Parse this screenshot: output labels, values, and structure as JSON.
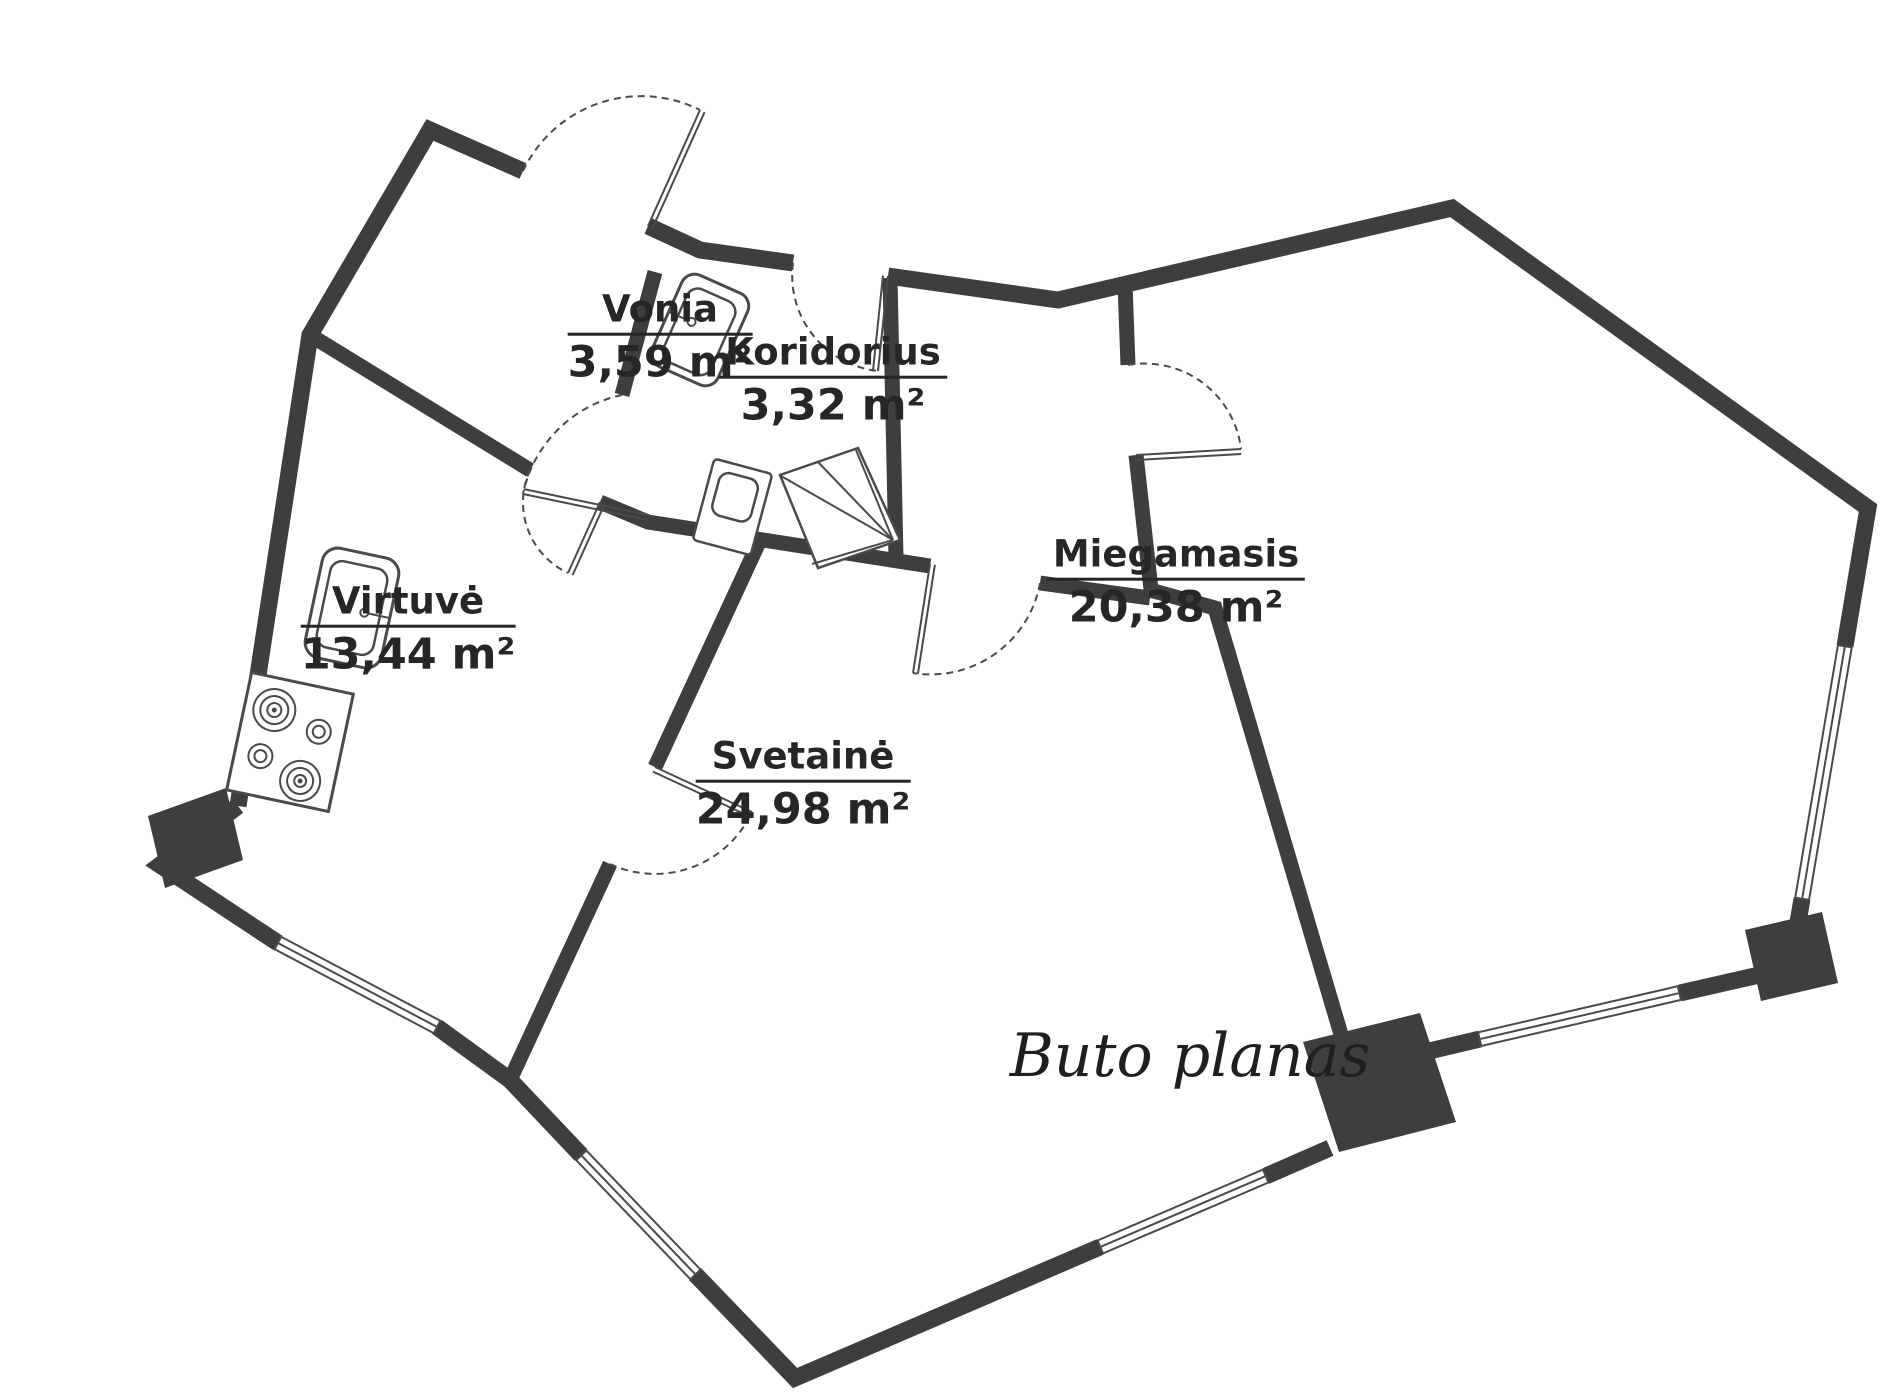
{
  "plan": {
    "title": "Buto planas",
    "rooms": [
      {
        "id": "vonia",
        "name": "Vonia",
        "area": "3,59 m²"
      },
      {
        "id": "koridorius",
        "name": "Koridorius",
        "area": "3,32 m²"
      },
      {
        "id": "virtuve",
        "name": "Virtuvė",
        "area": "13,44 m²"
      },
      {
        "id": "svetaine",
        "name": "Svetainė",
        "area": "24,98 m²"
      },
      {
        "id": "miegamasis",
        "name": "Miegamasis",
        "area": "20,38 m²"
      }
    ],
    "fixtures": [
      {
        "name": "bathroom-sink-icon"
      },
      {
        "name": "toilet-icon"
      },
      {
        "name": "corner-shower-icon"
      },
      {
        "name": "kitchen-sink-icon"
      },
      {
        "name": "stove-icon"
      }
    ],
    "colors": {
      "wall": "#3e3e3e",
      "line": "#4a4a4a",
      "text": "#262626",
      "background": "#ffffff"
    }
  }
}
